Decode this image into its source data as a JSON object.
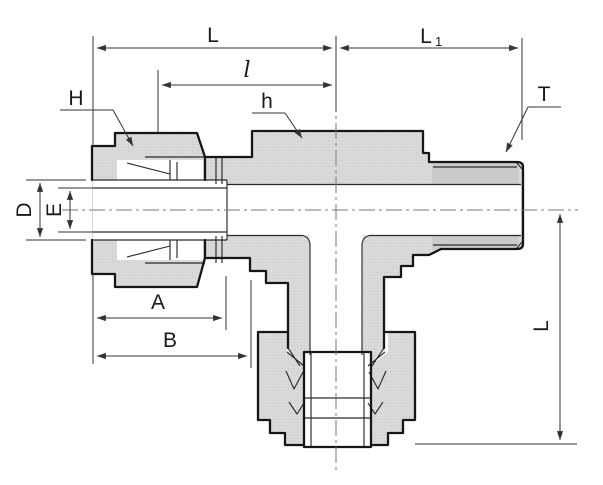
{
  "drawing": {
    "labels": {
      "top_span": "L",
      "right_span_main": "L",
      "right_span_sub": "1",
      "insertion_span": "l",
      "nut_hex": "H",
      "body_hex": "h",
      "thread": "T",
      "dia_outer": "D",
      "dia_inner": "E",
      "span_a": "A",
      "span_b": "B",
      "branch_length": "L"
    },
    "colors": {
      "outline": "#161616",
      "body_fill": "#dcdcdc",
      "hatch_line": "#c9c9c9",
      "thread_band": "#cbcbcb",
      "dimension_line": "#333333",
      "centerline": "#777777",
      "background": "#ffffff"
    }
  }
}
